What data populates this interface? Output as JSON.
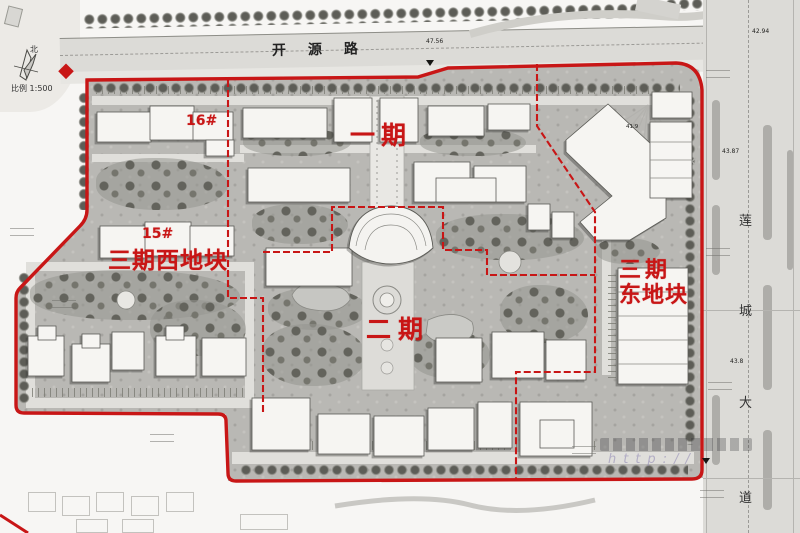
{
  "compass": {
    "north_label": "北",
    "scale_label": "比例  1:500"
  },
  "roads": {
    "top_name": "开源路",
    "right_chars": [
      "莲",
      "城",
      "大",
      "道"
    ]
  },
  "phases": {
    "phase1": "一期",
    "phase2": "二期",
    "phase3_west": "三期西地块",
    "phase3_east_line1": "三期",
    "phase3_east_line2": "东地块"
  },
  "building_labels": {
    "b15": "15#",
    "b16": "16#"
  },
  "elevations": {
    "e1": "47.56",
    "e2": "42.94",
    "e3": "43.87",
    "e4": "43.8",
    "e5": "41.9"
  },
  "watermark": {
    "url_line": "http://"
  },
  "colors": {
    "boundary_red": "#c81616",
    "site_gray": "#b9b8b4",
    "road_gray": "#dcdbd7"
  }
}
